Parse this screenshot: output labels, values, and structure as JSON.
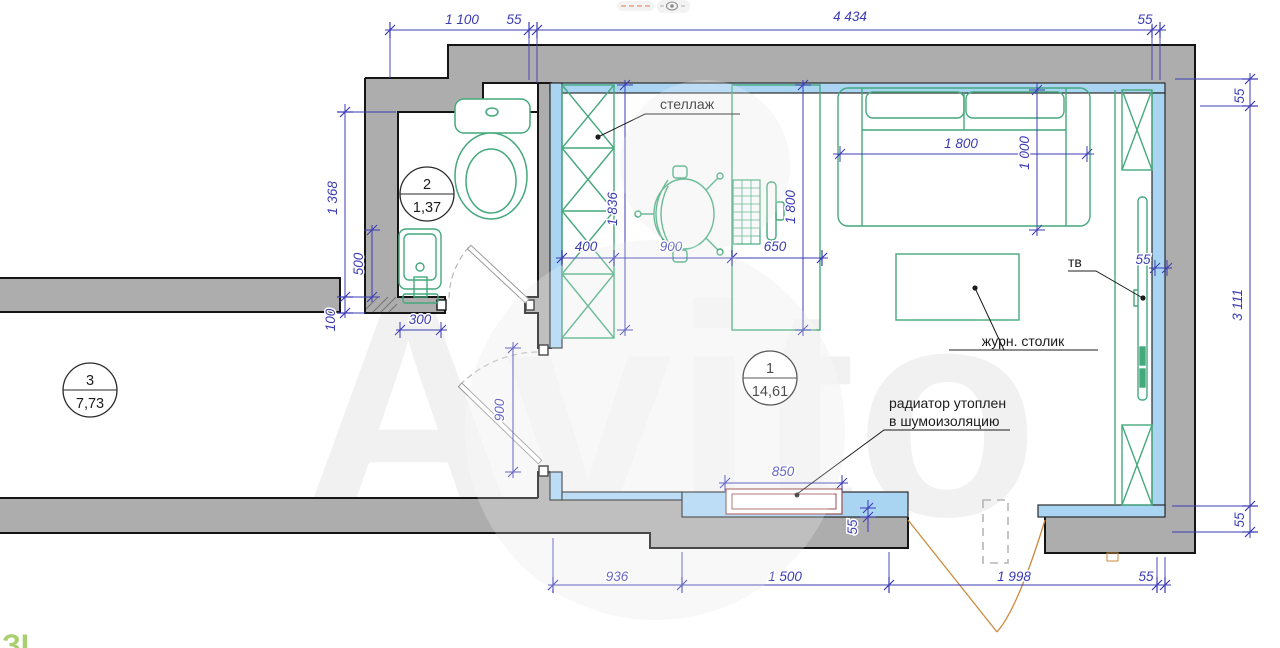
{
  "ui": {
    "watermark": "Avito",
    "corner_fragment": "ЗІ"
  },
  "labels": {
    "shelving": "стеллаж",
    "tv": "тв",
    "coffee_table": "журн. столик",
    "radiator_line1": "радиатор утоплен",
    "radiator_line2": "в шумоизоляцию"
  },
  "rooms": [
    {
      "number": "1",
      "area": "14,61"
    },
    {
      "number": "2",
      "area": "1,37"
    },
    {
      "number": "3",
      "area": "7,73"
    }
  ],
  "dims": {
    "top": [
      "1 100",
      "55",
      "4 434",
      "55"
    ],
    "right": [
      "55",
      "3 111",
      "55"
    ],
    "bottom": [
      "936",
      "1 500",
      "1 998",
      "55"
    ],
    "left": [
      "1 368",
      "100"
    ],
    "bath": {
      "sink_height": "500",
      "sink_width": "300"
    },
    "interior": {
      "shelf_width": "400",
      "chair_zone": "900",
      "desk_width": "650",
      "shelf_length": "1 836",
      "desk_length": "1 800",
      "sofa_width": "1 800",
      "sofa_depth": "1 000",
      "door_width": "900",
      "radiator_width": "850",
      "radiator_recess": "55",
      "tv_offset": "55"
    }
  },
  "colors": {
    "wall": "#adadad",
    "outline": "#151515",
    "insulation": "#a9d4f2",
    "furniture": "#44a97c",
    "dimension": "#3b3bb5",
    "door_swing": "#cc8a3d",
    "radiator": "#9b4f4f"
  }
}
